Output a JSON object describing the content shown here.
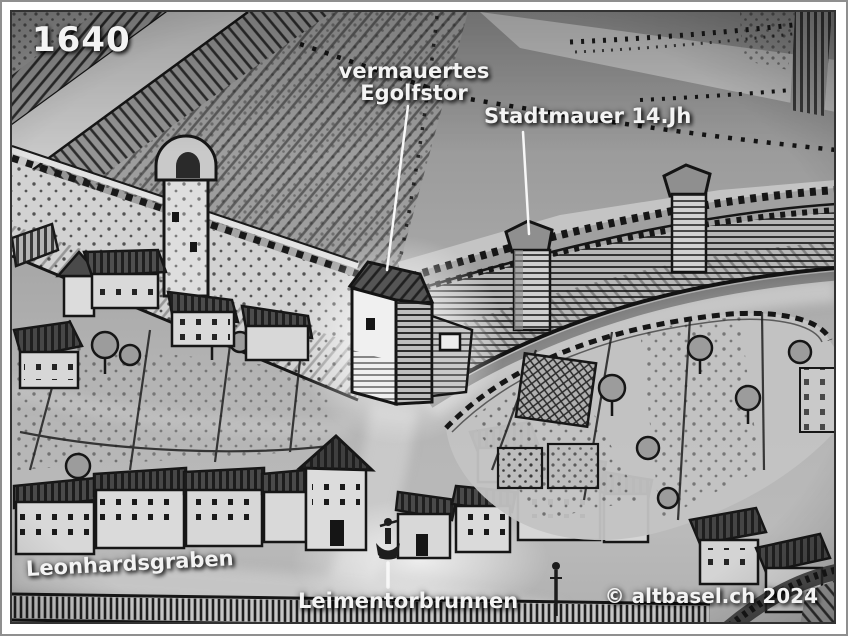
{
  "map": {
    "year": "1640",
    "labels": {
      "egolfstor": {
        "line1": "vermauertes",
        "line2": "Egolfstor"
      },
      "stadtmauer": "Stadtmauer 14.Jh",
      "leonhardsgraben": "Leonhardsgraben",
      "leimentorbrunnen": "Leimentorbrunnen"
    },
    "copyright": "© altbasel.ch 2024"
  },
  "colors": {
    "label_text": "#f3f3f3",
    "engraving_ink": "#181818",
    "paper_light": "#d2d2d2",
    "street_gray": "#c3c3c3",
    "frame_inner": "#333333",
    "frame_outer": "#8f8f8f"
  }
}
